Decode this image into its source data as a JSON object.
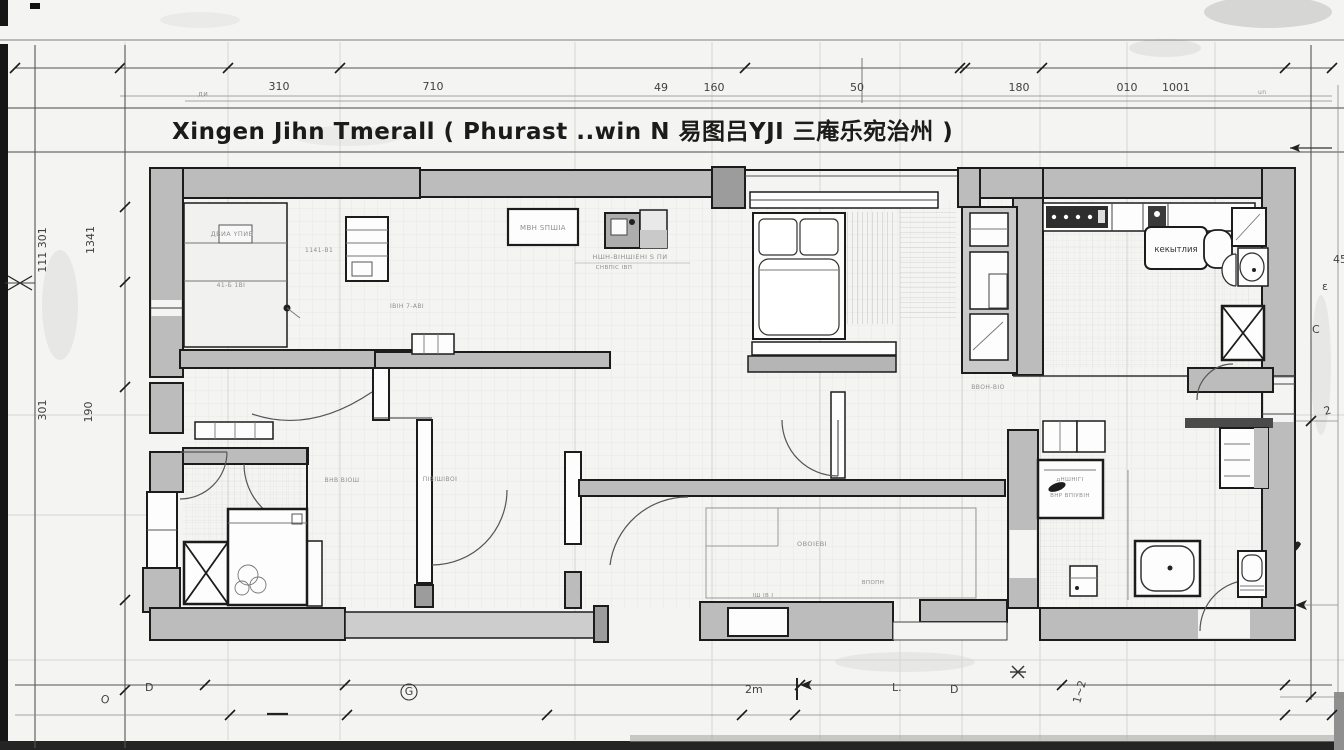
{
  "sheet": {
    "title": "Xingen Jihn Tmerall ( Phurast ..win  N 易图吕YJI 三庵乐宛治州 )",
    "kind": "architectural floor plan working drawing"
  },
  "colors": {
    "paper": "#f4f4f2",
    "ink": "#1c1c1c",
    "wall": "#bcbcbc",
    "wallDark": "#9c9c9c",
    "wallLight": "#cdcdcd",
    "dimInk": "#3f3f3f",
    "faint": "#d6d6d3",
    "scribble": "#8f8f8f",
    "frame": "#6a6a6a",
    "black": "#1a1a1a"
  },
  "dims": {
    "top": [
      {
        "v": "310"
      },
      {
        "v": "710"
      },
      {
        "v": "49"
      },
      {
        "v": "160"
      },
      {
        "v": "50"
      },
      {
        "v": "180"
      },
      {
        "v": "010"
      },
      {
        "v": "1001"
      }
    ],
    "left": [
      {
        "v": "111 301"
      },
      {
        "v": "1341"
      },
      {
        "v": "301"
      },
      {
        "v": "190"
      }
    ],
    "right": [
      {
        "v": "45"
      },
      {
        "v": "ε"
      },
      {
        "v": "C"
      },
      {
        "v": "2"
      }
    ],
    "bottom": [
      {
        "v": "O"
      },
      {
        "v": "D"
      },
      {
        "v": "G"
      },
      {
        "v": "2m"
      },
      {
        "v": "L."
      },
      {
        "v": "D"
      },
      {
        "v": "1~2"
      }
    ]
  },
  "scribbles": [
    {
      "t": "ДВИА ҮПИВ"
    },
    {
      "t": "1141-В1"
    },
    {
      "t": "НШН-ВІНШІЕНІ S ПИ"
    },
    {
      "t": "СНВПІС ІВП"
    },
    {
      "t": "МВН SПШІА"
    },
    {
      "t": "ІВІН 7-АВІ"
    },
    {
      "t": "ВВОН-ВІО"
    },
    {
      "t": "ОВОІЕВІ"
    },
    {
      "t": "ВПОПН"
    },
    {
      "t": "ПІВІШІВОІ"
    },
    {
      "t": "ВНВ ВІОШ"
    },
    {
      "t": "ІШ ІВ І"
    },
    {
      "t": "кекытлия"
    },
    {
      "t": "ВНР ВПІУВІН"
    },
    {
      "t": "дНШНІГІ"
    },
    {
      "t": "41-Б 1ВІ"
    },
    {
      "t": "ди"
    },
    {
      "t": "un"
    }
  ]
}
